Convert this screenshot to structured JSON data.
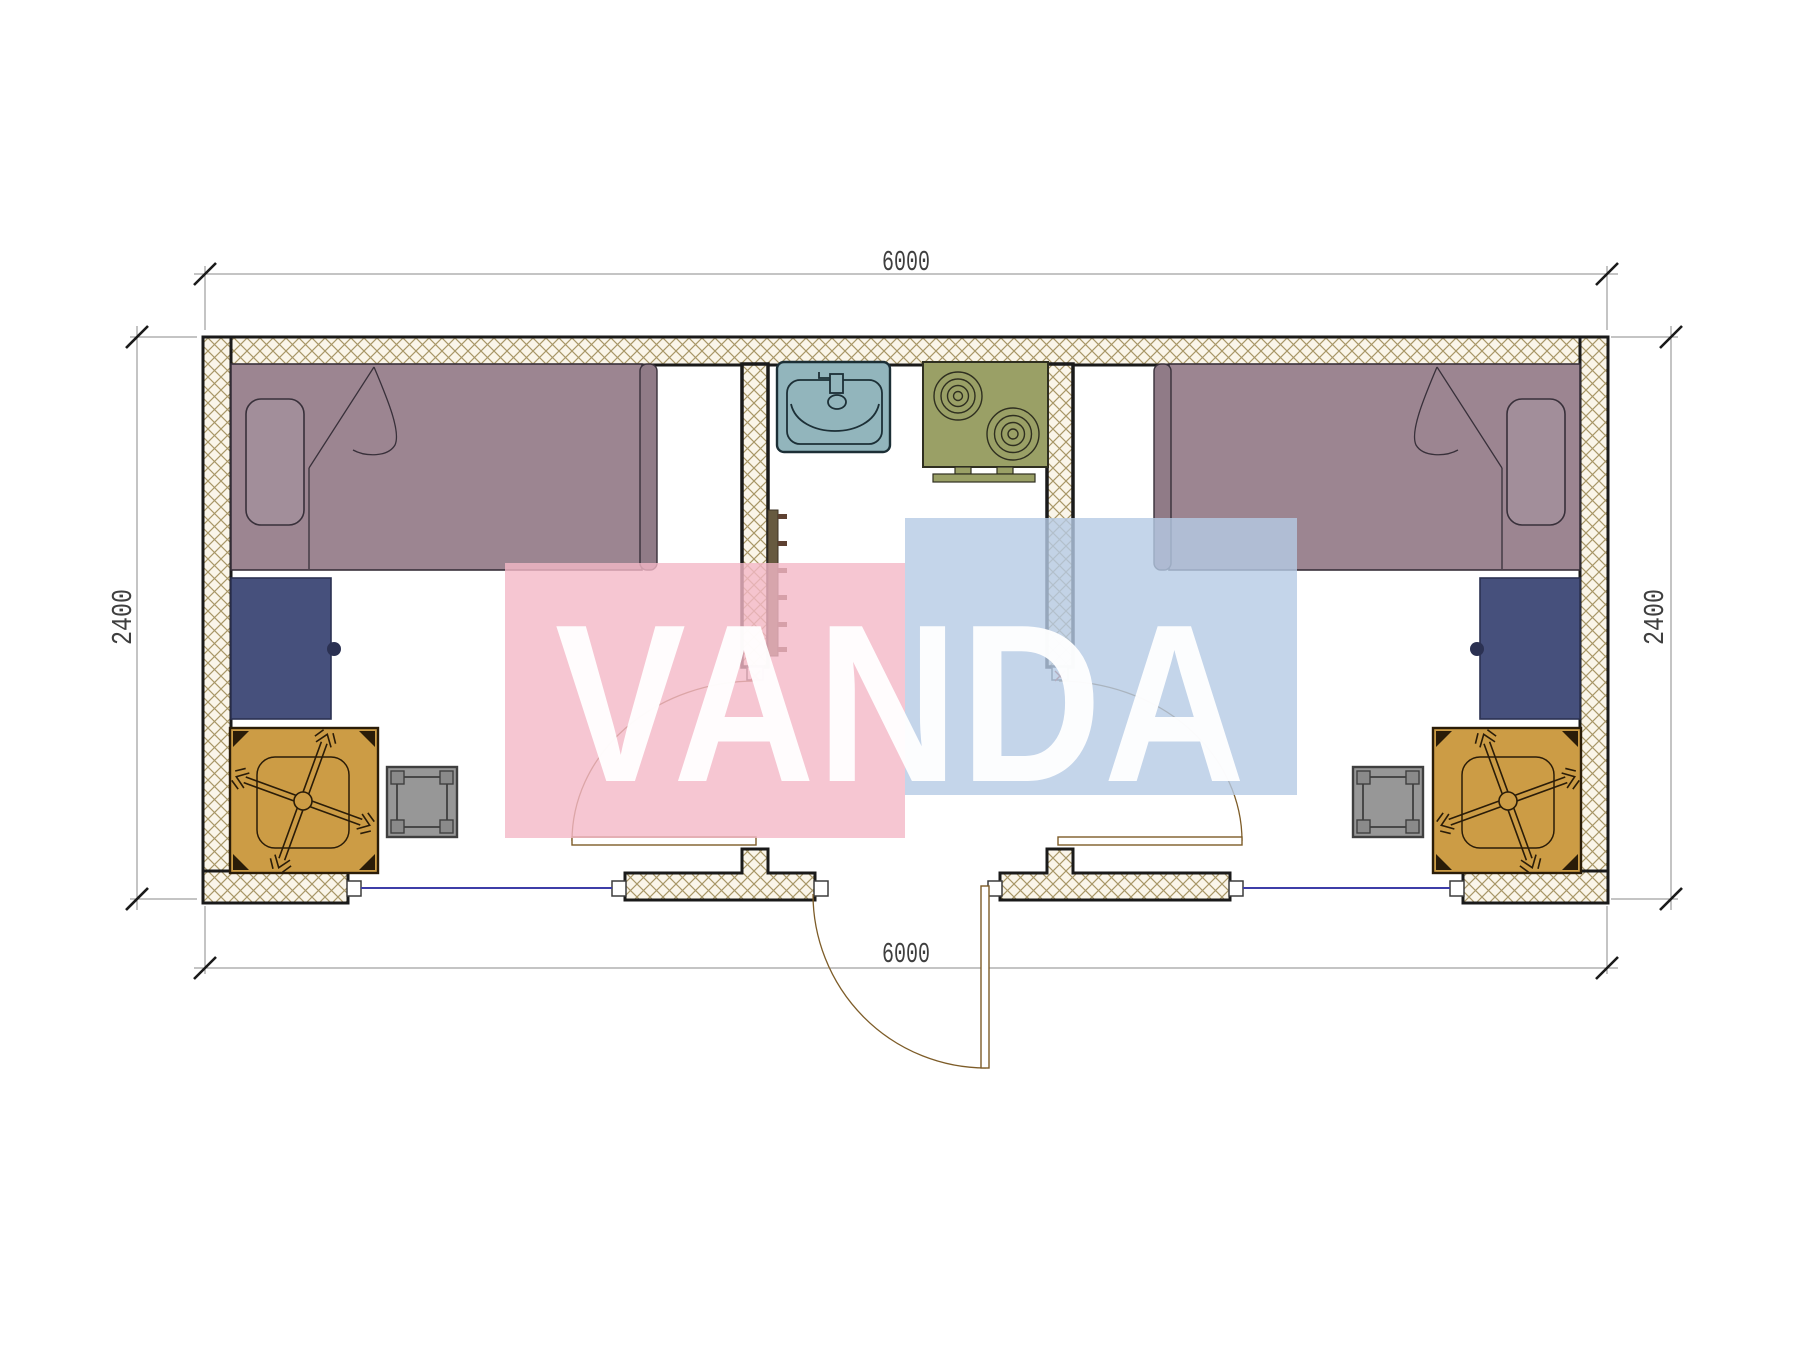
{
  "page": {
    "background": "#ffffff"
  },
  "plan": {
    "type": "floor-plan",
    "watermark": {
      "text": "VANDA"
    },
    "dimensions": {
      "top": "6000",
      "bottom": "6000",
      "left": "2400",
      "right": "2400"
    },
    "rooms": {
      "left_bedroom": [
        "bed",
        "pillow",
        "desk",
        "office-chair",
        "stool",
        "interior-door"
      ],
      "kitchen_core": [
        "sink",
        "two-burner-stove",
        "towel-ladder",
        "entrance-door"
      ],
      "right_bedroom": [
        "bed",
        "pillow",
        "desk",
        "office-chair",
        "stool",
        "interior-door"
      ]
    },
    "openings": {
      "windows": 2,
      "interior_doors": 2,
      "entrance_doors": 1
    }
  },
  "colors": {
    "page-bg": "#ffffff",
    "ink": "#1a1a1a",
    "dimline": "#8a8a8a",
    "dimtext": "#3f3f3f",
    "hatch_bg": "#faf5e9",
    "hatch_line": "#a89767",
    "bed": "#9c8591",
    "bed_dark": "#907b87",
    "pillow": "#a28e9a",
    "furnline": "#38303a",
    "desk": "#46507c",
    "desk_dark": "#2b3152",
    "chair": "#cc9c45",
    "chairline": "#2a1c08",
    "stool": "#979797",
    "stool_line": "#3f3f3f",
    "stool_leg": "#8a8a8a",
    "sink": "#92b5bc",
    "sinkline": "#1c2f36",
    "stove": "#9aa066",
    "stoveline": "#2f2f20",
    "ladder_bar": "#675a40",
    "ladder_rung": "#5e4132",
    "door": "#7d5c28",
    "hinge": "#a23524",
    "window": "#3d3da8",
    "wm_pink": "rgba(244,184,199,0.80)",
    "wm_blue": "rgba(181,203,229,0.80)",
    "wm_text": "rgba(255,255,255,0.95)"
  }
}
